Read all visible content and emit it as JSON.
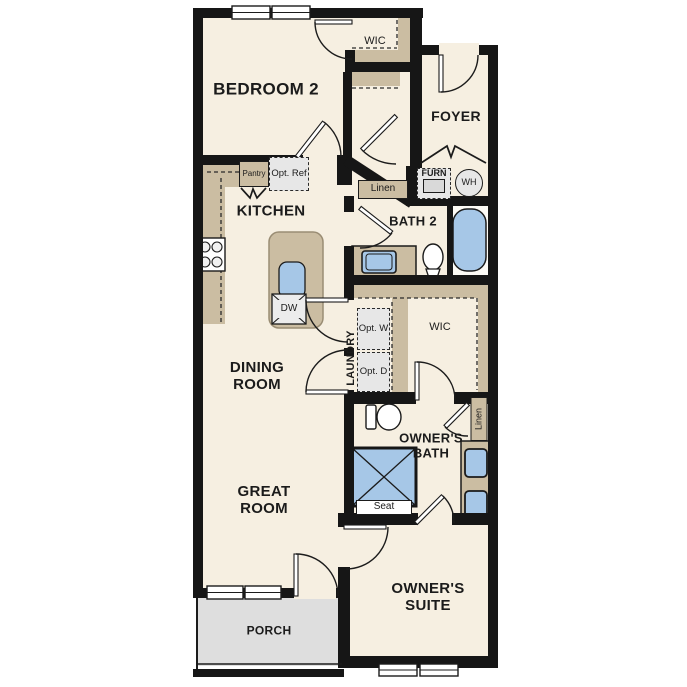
{
  "plan_title": "Single-story floor plan",
  "colors": {
    "floor": "#f6efe1",
    "walls": "#161616",
    "casework_tan": "#cbbda2",
    "fixture_blue": "#a6c7e7",
    "porch_gray": "#dedede",
    "appliance_gray": "#e7e7e7"
  },
  "rooms": {
    "bedroom2": "BEDROOM 2",
    "wic_upper": "WIC",
    "foyer": "FOYER",
    "kitchen": "KITCHEN",
    "bath2": "BATH 2",
    "dining_room": "DINING ROOM",
    "laundry": "LAUNDRY",
    "wic_middle": "WIC",
    "owners_bath": "OWNER'S BATH",
    "great_room": "GREAT ROOM",
    "owners_suite": "OWNER'S SUITE",
    "porch": "PORCH"
  },
  "features": {
    "pantry": "Pantry",
    "opt_ref": "Opt. Ref",
    "linen_upper": "Linen",
    "furnace": "FURN",
    "water_heater": "WH",
    "dishwasher": "DW",
    "opt_washer": "Opt. W",
    "opt_dryer": "Opt. D",
    "linen_owners": "Linen",
    "shower_seat": "Seat"
  }
}
